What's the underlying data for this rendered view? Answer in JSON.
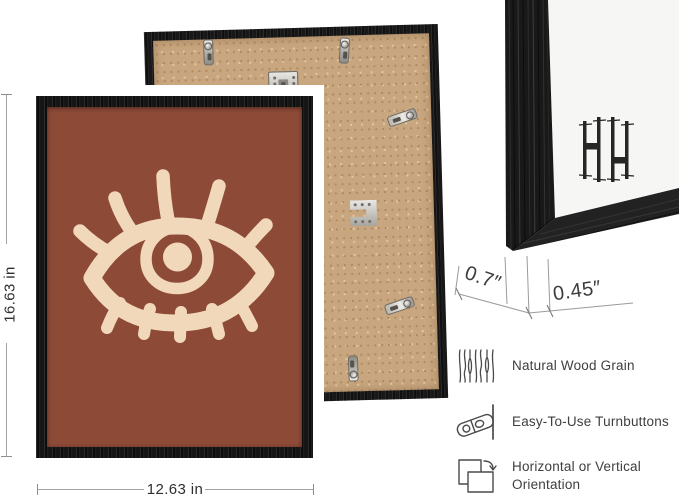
{
  "front_frame": {
    "height_label": "16.63 in",
    "width_label": "12.63 in",
    "art_motif": "abstract-eye"
  },
  "corner_detail": {
    "depth_label": "0.7″",
    "face_label": "0.45″",
    "logo": "HH monogram"
  },
  "features": [
    {
      "icon": "wood-grain-icon",
      "label": "Natural Wood Grain"
    },
    {
      "icon": "turnbutton-icon",
      "label": "Easy-To-Use Turnbuttons"
    },
    {
      "icon": "orientation-icon",
      "label_line1": "Horizontal or Vertical",
      "label_line2": "Orientation"
    }
  ],
  "colors": {
    "frame_black": "#1a1a1a",
    "art_background": "#8d4a37",
    "art_motif_cream": "#f2d8ba",
    "backing_board_tan": "#c8a67f",
    "annotation_text": "#3c3c3c"
  }
}
